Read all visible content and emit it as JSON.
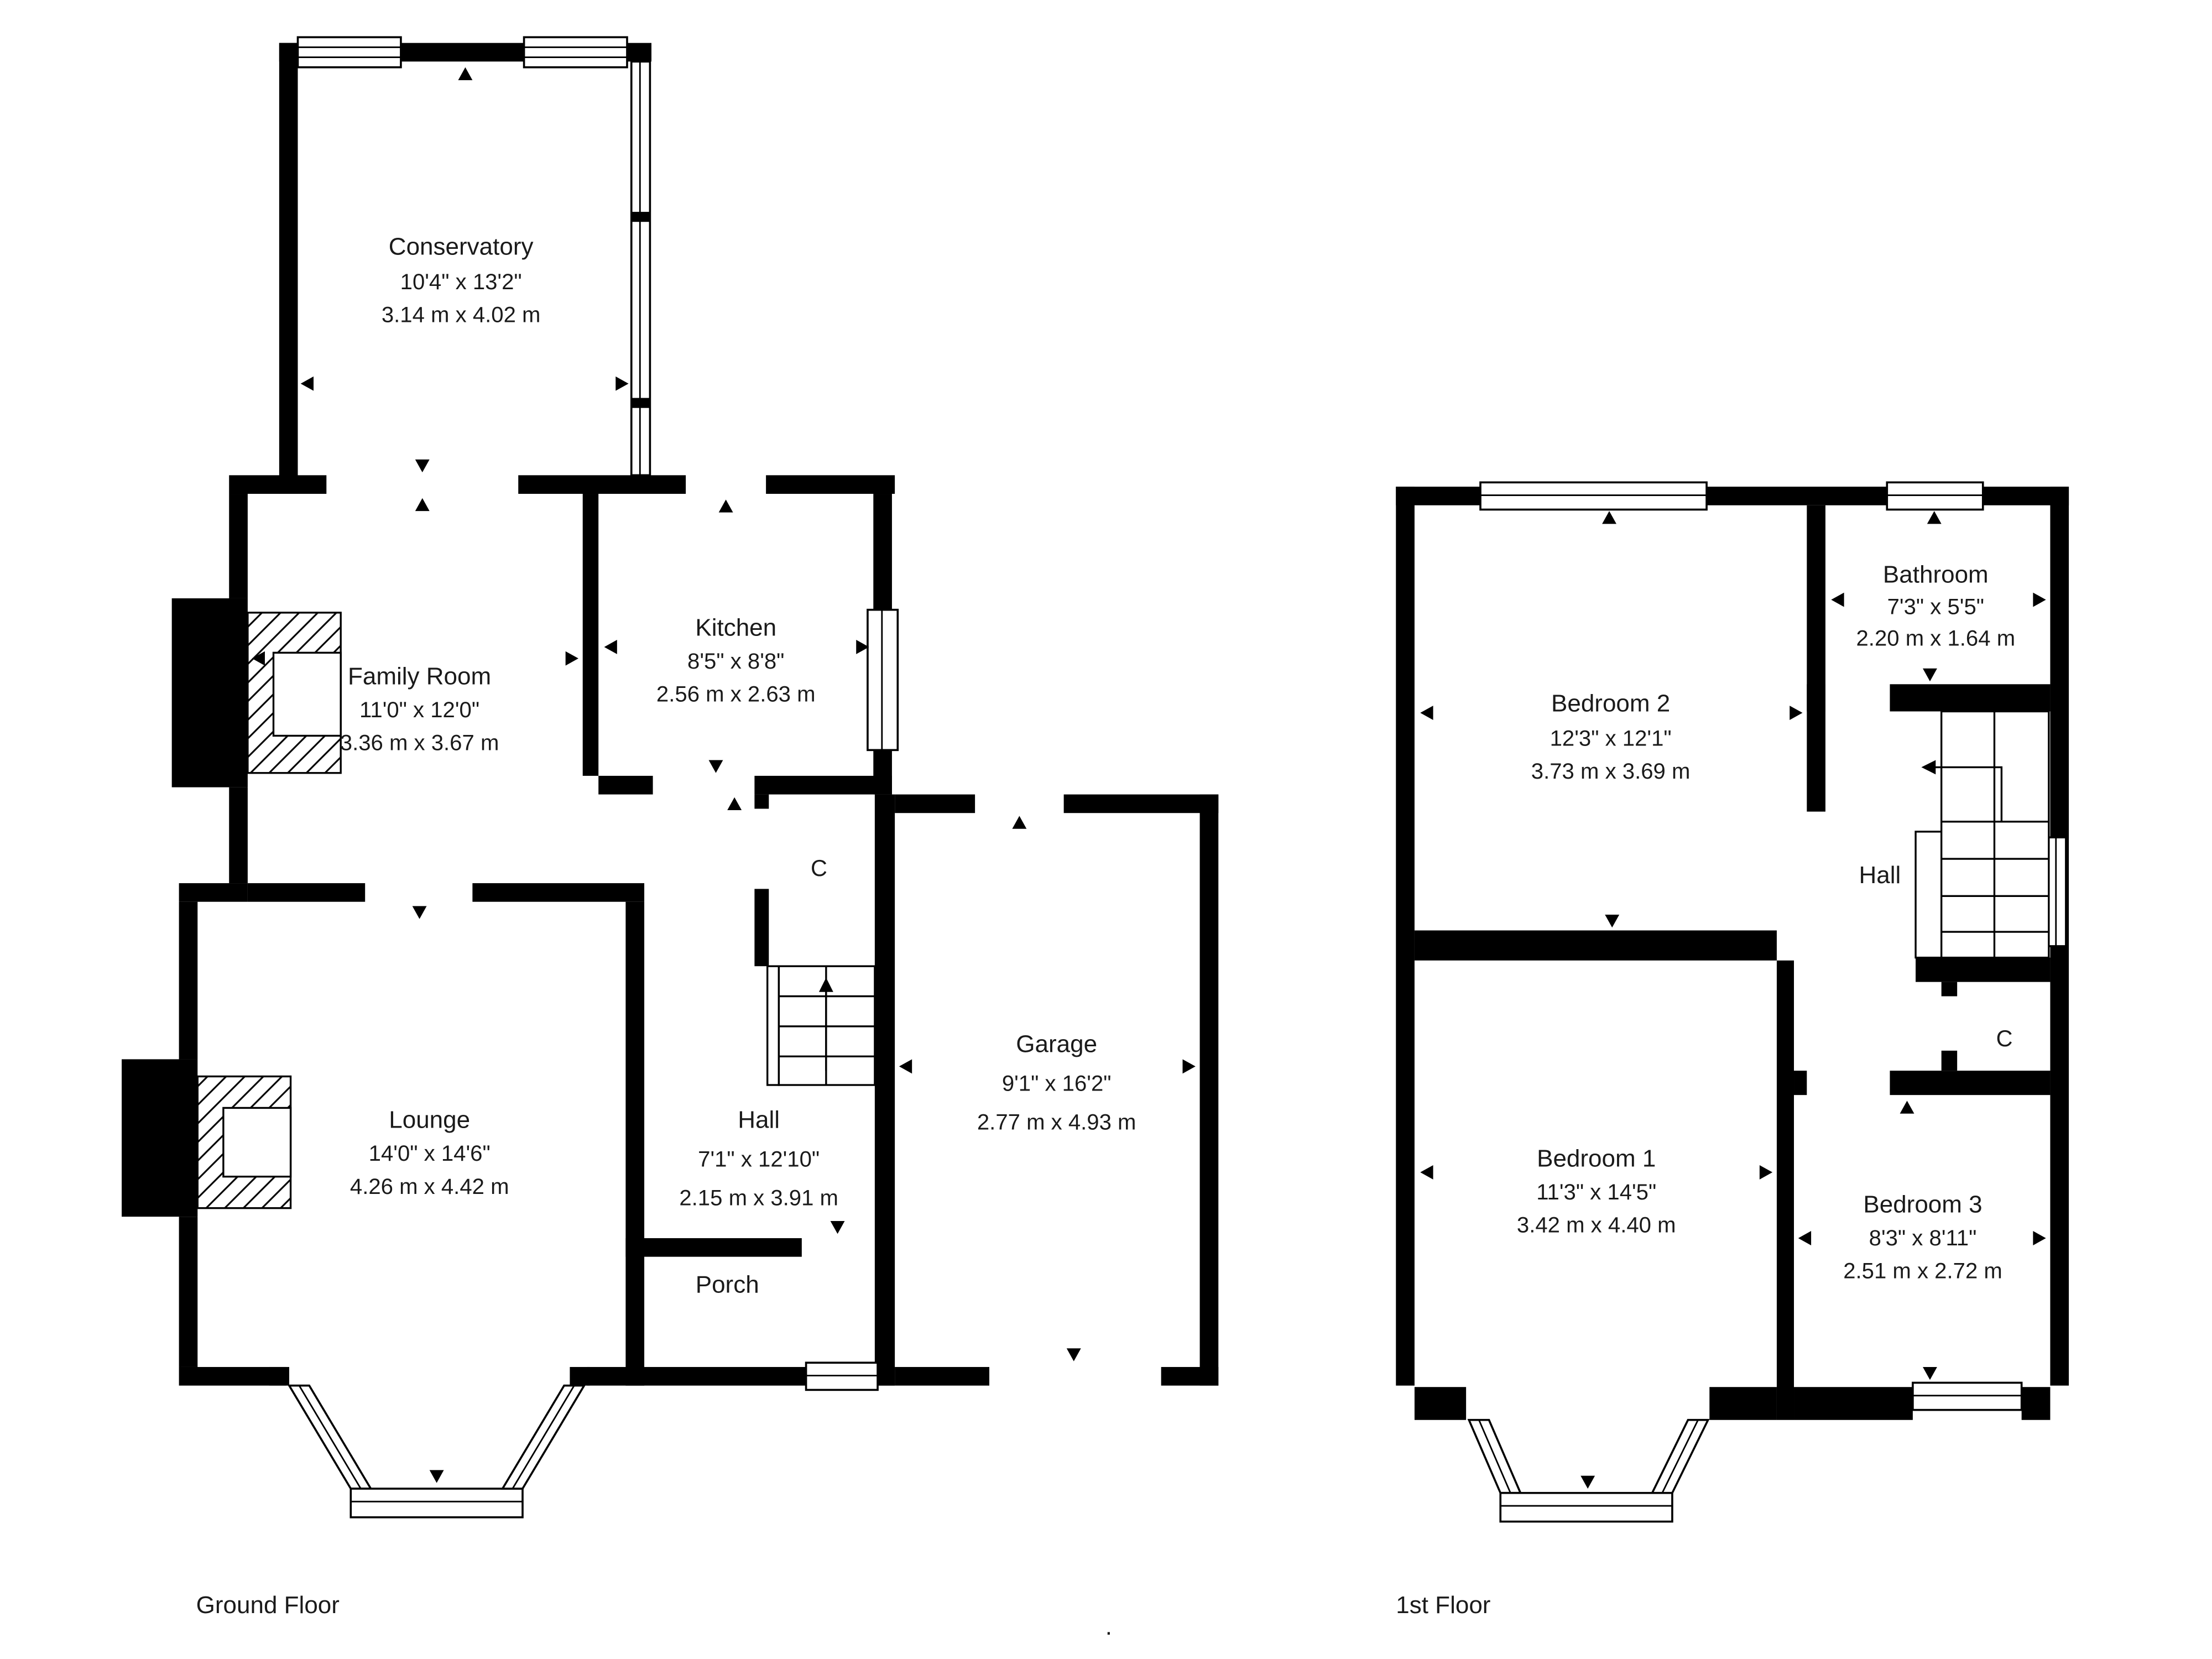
{
  "ground_floor": {
    "label": "Ground Floor",
    "rooms": {
      "conservatory": {
        "name": "Conservatory",
        "imperial": "10'4\" x 13'2\"",
        "metric": "3.14 m x 4.02 m"
      },
      "family_room": {
        "name": "Family Room",
        "imperial": "11'0\" x 12'0\"",
        "metric": "3.36 m x 3.67 m"
      },
      "kitchen": {
        "name": "Kitchen",
        "imperial": "8'5\" x 8'8\"",
        "metric": "2.56 m x 2.63 m"
      },
      "lounge": {
        "name": "Lounge",
        "imperial": "14'0\" x 14'6\"",
        "metric": "4.26 m x 4.42 m"
      },
      "hall": {
        "name": "Hall",
        "imperial": "7'1\" x 12'10\"",
        "metric": "2.15 m x 3.91 m"
      },
      "garage": {
        "name": "Garage",
        "imperial": "9'1\" x 16'2\"",
        "metric": "2.77 m x 4.93 m"
      },
      "porch": {
        "name": "Porch"
      },
      "closet": {
        "name": "C"
      }
    }
  },
  "first_floor": {
    "label": "1st Floor",
    "rooms": {
      "bedroom_2": {
        "name": "Bedroom 2",
        "imperial": "12'3\" x 12'1\"",
        "metric": "3.73 m x 3.69 m"
      },
      "bathroom": {
        "name": "Bathroom",
        "imperial": "7'3\" x 5'5\"",
        "metric": "2.20 m x 1.64 m"
      },
      "hall": {
        "name": "Hall"
      },
      "closet": {
        "name": "C"
      },
      "bedroom_1": {
        "name": "Bedroom 1",
        "imperial": "11'3\" x 14'5\"",
        "metric": "3.42 m x 4.40 m"
      },
      "bedroom_3": {
        "name": "Bedroom 3",
        "imperial": "8'3\" x 8'11\"",
        "metric": "2.51 m x 2.72 m"
      }
    }
  },
  "footnote": ".",
  "colors": {
    "wall": "#000000",
    "text": "#1a1a1a",
    "background": "#ffffff"
  }
}
